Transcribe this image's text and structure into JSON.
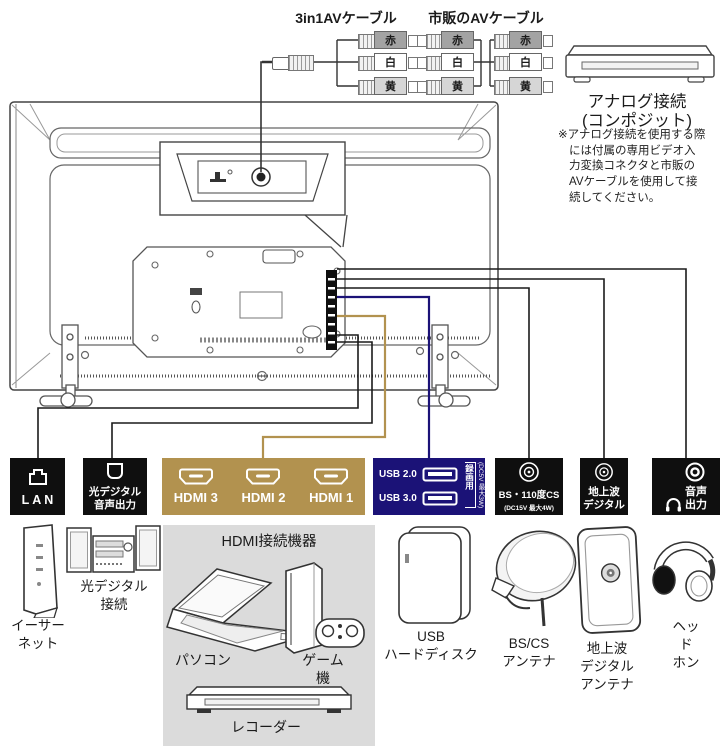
{
  "colors": {
    "gold": "#b2924f",
    "navy": "#1b1277",
    "box_black": "#0f0f0f",
    "hdmi_panel_gray": "#dbdbdb"
  },
  "cables": {
    "label_3in1": "3in1AVケーブル",
    "label_market": "市販のAVケーブル",
    "rca": [
      "赤",
      "白",
      "黄"
    ]
  },
  "analog": {
    "title": "アナログ接続",
    "subtitle": "(コンポジット)",
    "note": "※アナログ接続を使用する際\nには付属の専用ビデオ入\n力変換コネクタと市販の\nAVケーブルを使用して接\n続してください。"
  },
  "ports": {
    "lan": {
      "label": "LAN"
    },
    "optical": {
      "label": "光デジタル\n音声出力"
    },
    "hdmi": {
      "items": [
        "HDMI 3",
        "HDMI 2",
        "HDMI 1"
      ]
    },
    "usb": {
      "rows": [
        "USB 2.0",
        "USB 3.0"
      ],
      "note_vertical": "録画用",
      "power_vertical": "(DC5V 最大3W)"
    },
    "bs": {
      "label": "BS・110度CS",
      "sub": "(DC15V 最大4W)"
    },
    "terrestrial": {
      "label": "地上波\nデジタル"
    },
    "audio": {
      "label": "音声\n出力"
    }
  },
  "devices": {
    "ethernet": "イーサー\nネット",
    "optical_audio": "光デジタル\n接続",
    "hdmi_group_title": "HDMI接続機器",
    "pc": "パソコン",
    "game": "ゲーム機",
    "recorder": "レコーダー",
    "usb_hdd": "USB\nハードディスク",
    "bscs_antenna": "BS/CS\nアンテナ",
    "terrestrial_antenna": "地上波\nデジタル\nアンテナ",
    "headphone": "ヘッド\nホン"
  }
}
